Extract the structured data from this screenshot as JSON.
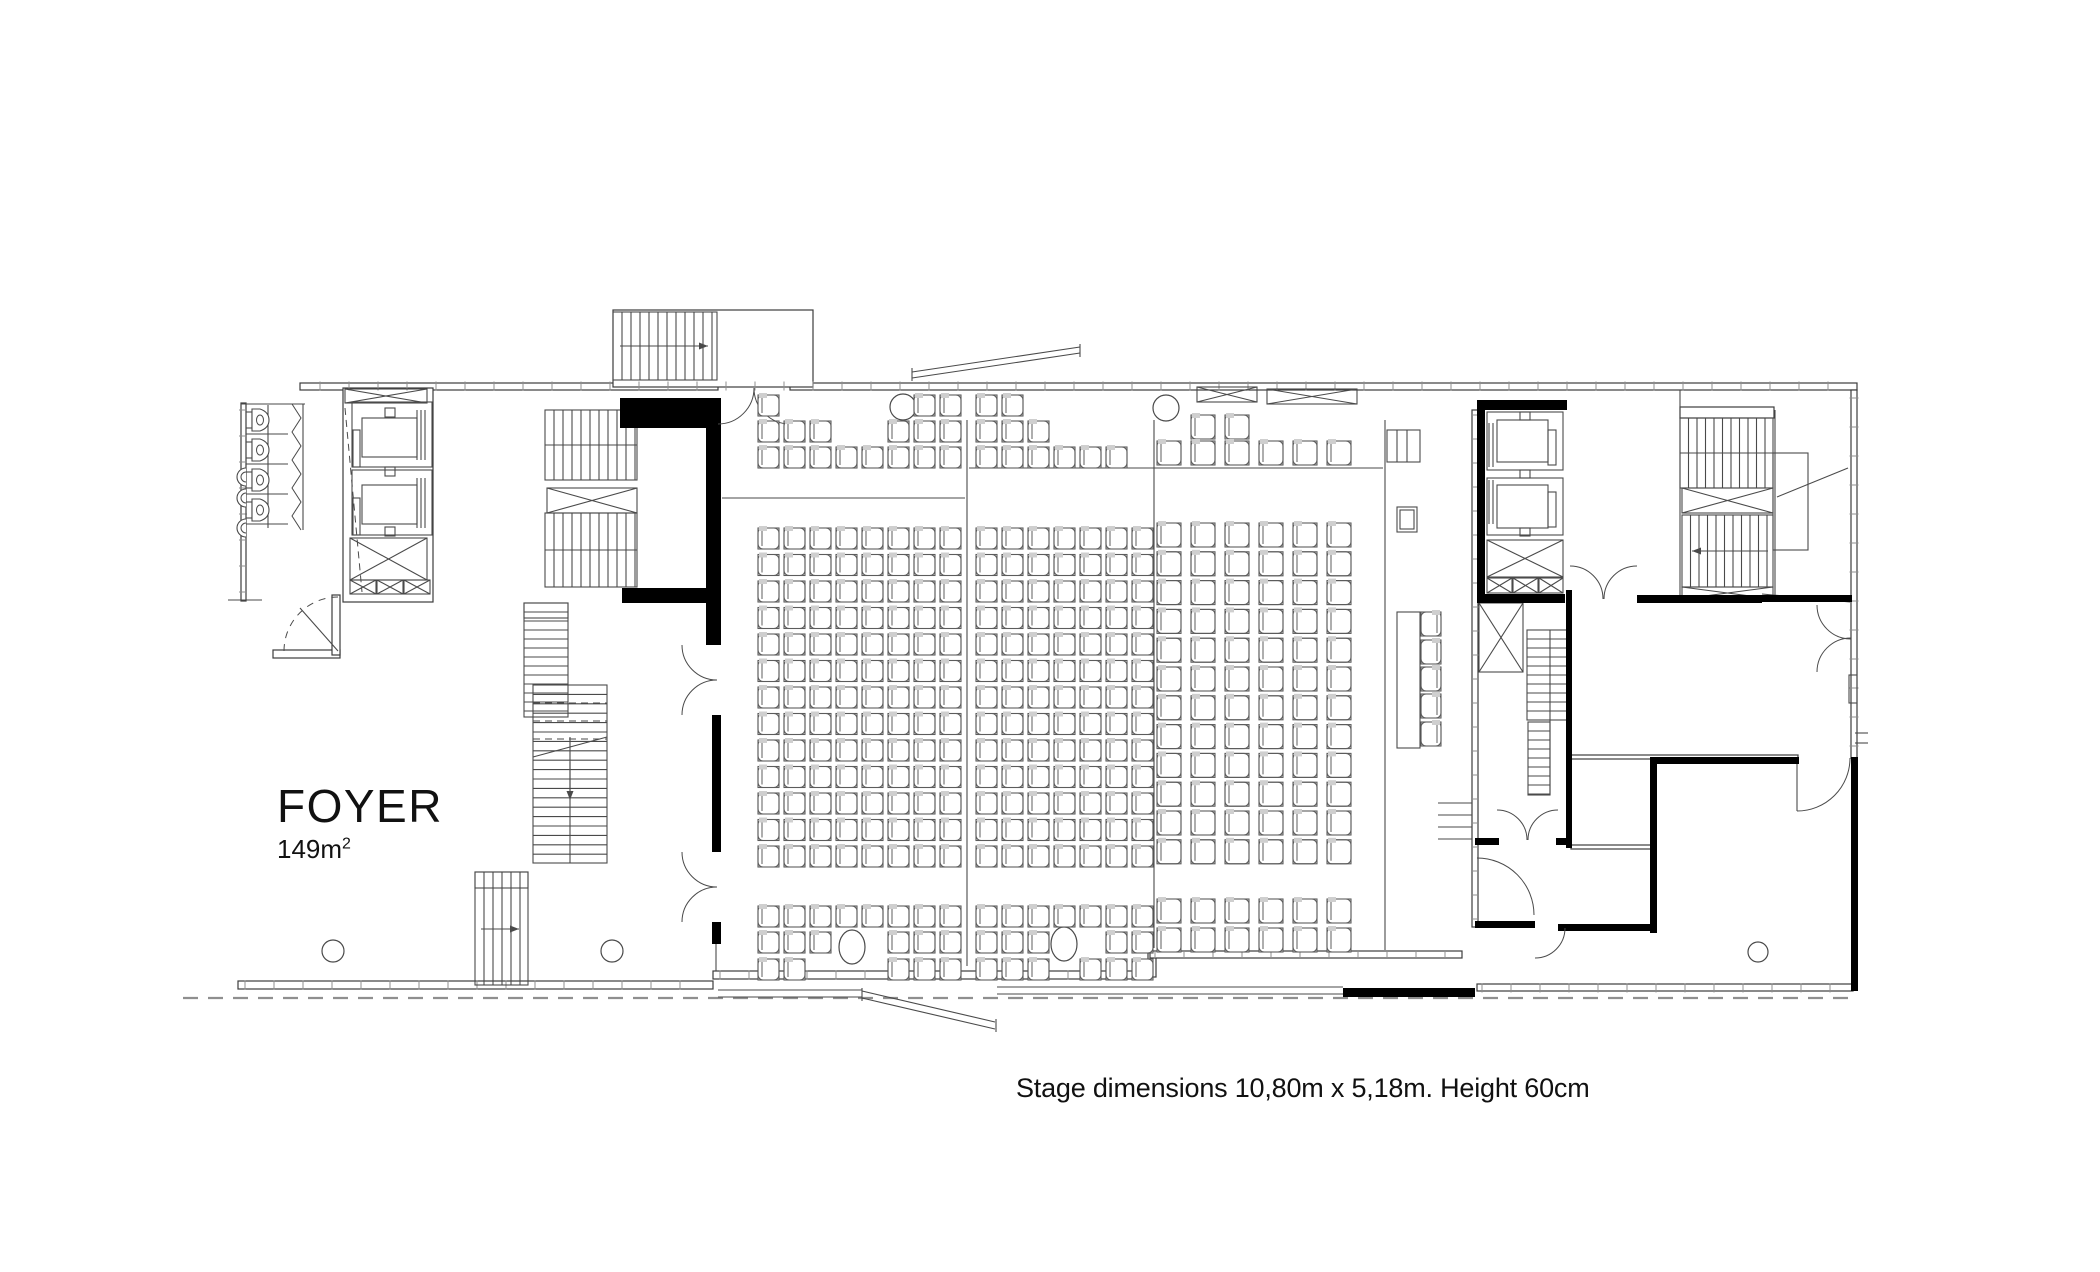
{
  "labels": {
    "room_name": "FOYER",
    "room_area_base": "149m",
    "room_area_exp": "2",
    "caption": "Stage dimensions 10,80m x 5,18m. Height 60cm"
  },
  "colors": {
    "background": "#ffffff",
    "line": "#4a4a4a",
    "line_light": "#8f8f8f",
    "wall_stroke": "#3c3c3c",
    "wall_black": "#000000",
    "seat": "#5c5c5c",
    "seat_tab": "#cfcfcf",
    "text": "#111111"
  },
  "canvas": {
    "width": 2100,
    "height": 1272
  },
  "plan": {
    "ground": [
      183,
      998,
      1852,
      998
    ],
    "walls": [
      [
        300,
        383,
        418,
        7
      ],
      [
        790,
        383,
        1067,
        7
      ],
      [
        613,
        310,
        200,
        77
      ],
      [
        241,
        403,
        5,
        198
      ],
      [
        238,
        981,
        475,
        8
      ],
      [
        713,
        971,
        437,
        8
      ],
      [
        1148,
        953,
        8,
        24
      ],
      [
        1150,
        951,
        312,
        7
      ],
      [
        1477,
        984,
        376,
        7
      ],
      [
        1851,
        390,
        6,
        368
      ],
      [
        343,
        388,
        90,
        214
      ],
      [
        1472,
        410,
        6,
        517
      ],
      [
        1570,
        755,
        228,
        4
      ],
      [
        1571,
        845,
        80,
        4
      ],
      [
        273,
        650,
        67,
        8
      ],
      [
        332,
        595,
        8,
        60
      ],
      [
        1680,
        407,
        94,
        11
      ]
    ],
    "blacks": [
      [
        620,
        398,
        92,
        30
      ],
      [
        706,
        398,
        15,
        247
      ],
      [
        712,
        715,
        9,
        137
      ],
      [
        712,
        922,
        9,
        22
      ],
      [
        622,
        588,
        88,
        15
      ],
      [
        1477,
        400,
        90,
        10
      ],
      [
        1477,
        400,
        8,
        203
      ],
      [
        1477,
        594,
        88,
        9
      ],
      [
        1637,
        595,
        125,
        8
      ],
      [
        1762,
        595,
        90,
        7
      ],
      [
        1566,
        590,
        6,
        258
      ],
      [
        1475,
        838,
        24,
        7
      ],
      [
        1556,
        838,
        16,
        7
      ],
      [
        1475,
        921,
        60,
        7
      ],
      [
        1558,
        924,
        99,
        7
      ],
      [
        1653,
        757,
        146,
        7
      ],
      [
        1650,
        757,
        7,
        176
      ],
      [
        1851,
        757,
        7,
        234
      ],
      [
        1343,
        988,
        132,
        9
      ]
    ],
    "xboxes": [
      [
        345,
        389,
        82,
        14
      ],
      [
        350,
        538,
        77,
        42
      ],
      [
        350,
        580,
        26,
        14
      ],
      [
        377,
        580,
        26,
        14
      ],
      [
        404,
        580,
        26,
        14
      ],
      [
        547,
        488,
        90,
        25
      ],
      [
        1487,
        540,
        76,
        37
      ],
      [
        1487,
        578,
        25,
        15
      ],
      [
        1513,
        578,
        25,
        15
      ],
      [
        1539,
        578,
        24,
        15
      ],
      [
        1479,
        603,
        44,
        69
      ],
      [
        1682,
        488,
        91,
        25
      ],
      [
        1682,
        587,
        91,
        12
      ],
      [
        1197,
        387,
        60,
        15
      ],
      [
        1267,
        389,
        90,
        15
      ]
    ],
    "stairs": [
      [
        613,
        312,
        104,
        68,
        "h",
        9
      ],
      [
        545,
        410,
        92,
        70,
        "h",
        9
      ],
      [
        545,
        513,
        92,
        74,
        "h",
        9
      ],
      [
        524,
        603,
        44,
        114,
        "v",
        9
      ],
      [
        533,
        685,
        74,
        178,
        "v",
        9.4
      ],
      [
        475,
        872,
        53,
        113,
        "h",
        9
      ],
      [
        1680,
        418,
        93,
        70,
        "h",
        8.5
      ],
      [
        1682,
        515,
        91,
        72,
        "h",
        8.5
      ],
      [
        1527,
        630,
        40,
        90,
        "v",
        9
      ],
      [
        1528,
        722,
        22,
        73,
        "v",
        9
      ]
    ],
    "rects": [
      [
        352,
        402,
        80,
        65
      ],
      [
        362,
        418,
        55,
        39
      ],
      [
        352,
        470,
        80,
        65
      ],
      [
        362,
        485,
        55,
        39
      ],
      [
        353,
        430,
        7,
        37
      ],
      [
        353,
        498,
        7,
        37
      ],
      [
        385,
        408,
        10,
        9
      ],
      [
        385,
        467,
        10,
        9
      ],
      [
        385,
        527,
        10,
        9
      ],
      [
        1487,
        412,
        76,
        58
      ],
      [
        1497,
        420,
        51,
        42
      ],
      [
        1487,
        478,
        76,
        57
      ],
      [
        1497,
        485,
        51,
        43
      ],
      [
        1548,
        430,
        8,
        35
      ],
      [
        1548,
        492,
        8,
        35
      ],
      [
        1520,
        412,
        10,
        8
      ],
      [
        1520,
        470,
        10,
        8
      ],
      [
        1520,
        528,
        10,
        8
      ],
      [
        1397,
        507,
        20,
        25
      ],
      [
        1400,
        510,
        14,
        19
      ],
      [
        1387,
        430,
        33,
        32
      ],
      [
        1397,
        612,
        23,
        136
      ],
      [
        1849,
        675,
        8,
        28
      ],
      [
        1773,
        453,
        35,
        97
      ],
      [
        524,
        603,
        44,
        15
      ],
      [
        475,
        872,
        53,
        16
      ]
    ],
    "lines": [
      [
        967,
        420,
        967,
        966
      ],
      [
        1154,
        420,
        1154,
        948
      ],
      [
        1385,
        420,
        1385,
        950
      ],
      [
        722,
        498,
        965,
        498
      ],
      [
        969,
        468,
        1383,
        468
      ],
      [
        268,
        405,
        268,
        528
      ],
      [
        241,
        404,
        305,
        404
      ],
      [
        246,
        434,
        288,
        434
      ],
      [
        246,
        464,
        288,
        464
      ],
      [
        246,
        494,
        288,
        494
      ],
      [
        246,
        524,
        288,
        524
      ],
      [
        303,
        404,
        303,
        530
      ],
      [
        228,
        600,
        262,
        600
      ],
      [
        417,
        410,
        417,
        460
      ],
      [
        421,
        410,
        421,
        460
      ],
      [
        425,
        410,
        425,
        460
      ],
      [
        417,
        478,
        417,
        528
      ],
      [
        421,
        478,
        421,
        528
      ],
      [
        425,
        478,
        425,
        528
      ],
      [
        1489,
        423,
        1489,
        467
      ],
      [
        1493,
        423,
        1493,
        467
      ],
      [
        1489,
        480,
        1489,
        524
      ],
      [
        1493,
        480,
        1493,
        524
      ],
      [
        1397,
        430,
        1397,
        462
      ],
      [
        1407,
        430,
        1407,
        462
      ],
      [
        1680,
        390,
        1680,
        601
      ],
      [
        1775,
        410,
        1775,
        601
      ],
      [
        1777,
        497,
        1848,
        468
      ],
      [
        1762,
        594,
        1850,
        602
      ],
      [
        1438,
        803,
        1472,
        803
      ],
      [
        1438,
        815,
        1472,
        815
      ],
      [
        1438,
        827,
        1472,
        827
      ],
      [
        1438,
        839,
        1472,
        839
      ],
      [
        912,
        378,
        1080,
        353
      ],
      [
        912,
        372,
        1080,
        347
      ],
      [
        912,
        368,
        912,
        381
      ],
      [
        1080,
        344,
        1080,
        357
      ],
      [
        718,
        990,
        862,
        990
      ],
      [
        718,
        997,
        862,
        997
      ],
      [
        862,
        991,
        995,
        1022
      ],
      [
        862,
        998,
        995,
        1029
      ],
      [
        997,
        987,
        1343,
        987
      ],
      [
        997,
        994,
        1343,
        994
      ],
      [
        862,
        988,
        862,
        1001
      ],
      [
        996,
        1019,
        996,
        1032
      ],
      [
        545,
        445,
        637,
        445
      ],
      [
        545,
        550,
        637,
        550
      ],
      [
        1680,
        453,
        1773,
        453
      ],
      [
        1550,
        630,
        1550,
        795
      ],
      [
        570,
        737,
        570,
        863
      ],
      [
        338,
        651,
        300,
        608
      ],
      [
        533,
        757,
        607,
        737
      ],
      [
        716,
        944,
        716,
        971
      ],
      [
        1797,
        758,
        1797,
        811
      ],
      [
        1855,
        733,
        1868,
        733
      ],
      [
        1855,
        743,
        1868,
        743
      ]
    ],
    "dashes": [
      [
        345,
        408,
        362,
        592
      ],
      [
        624,
        426,
        708,
        400
      ],
      [
        533,
        703,
        607,
        703
      ],
      [
        533,
        721,
        607,
        721
      ],
      [
        533,
        739,
        607,
        739
      ]
    ],
    "doors": [
      {
        "d": "M754,388 A36,36 0 0 1 718,424"
      },
      {
        "d": "M754,388 A36,36 0 0 0 790,424"
      },
      {
        "d": "M682,645 A35,35 0 0 0 717,680"
      },
      {
        "d": "M682,715 A35,35 0 0 1 717,680"
      },
      {
        "d": "M682,852 A35,35 0 0 0 717,887"
      },
      {
        "d": "M682,922 A35,35 0 0 1 717,887"
      },
      {
        "d": "M1603,599 A33,33 0 0 0 1570,566"
      },
      {
        "d": "M1604,599 A33,33 0 0 1 1637,566"
      },
      {
        "d": "M1817,605 A34,34 0 0 0 1851,639"
      },
      {
        "d": "M1817,672 A34,34 0 0 1 1851,638"
      },
      {
        "d": "M1850,758 A53,53 0 0 1 1797,811"
      },
      {
        "d": "M1527,840 A30,30 0 0 0 1497,810"
      },
      {
        "d": "M1528,840 A30,30 0 0 1 1558,810"
      },
      {
        "d": "M1477,858 A57,57 0 0 1 1534,915"
      },
      {
        "d": "M1565,928 A30,30 0 0 1 1535,958"
      },
      {
        "d": "M284,651 A54,54 0 0 1 338,597",
        "dash": true
      }
    ],
    "circles": [
      [
        903,
        407,
        13
      ],
      [
        1166,
        408,
        13
      ],
      [
        333,
        951,
        11
      ],
      [
        612,
        951,
        11
      ],
      [
        1758,
        952,
        10
      ]
    ],
    "ellipses": [
      [
        852,
        947,
        13,
        17
      ],
      [
        1064,
        944,
        13,
        17
      ]
    ],
    "tickruns": [
      [
        320,
        386,
        1845,
        386,
        29,
        9
      ],
      [
        720,
        975,
        1145,
        975,
        29,
        9
      ],
      [
        245,
        985,
        708,
        985,
        29,
        9
      ],
      [
        1482,
        988,
        1848,
        988,
        29,
        9
      ],
      [
        1854,
        398,
        1854,
        752,
        29,
        9
      ],
      [
        243,
        410,
        243,
        595,
        26,
        8
      ],
      [
        1475,
        415,
        1475,
        922,
        24,
        8
      ],
      [
        1155,
        954,
        1458,
        954,
        29,
        8
      ]
    ],
    "toilets": {
      "x": 246,
      "cys": [
        420,
        450,
        480,
        510
      ]
    },
    "urinals": {
      "x": 246,
      "cys": [
        477,
        498,
        528
      ]
    },
    "zigzags": [
      {
        "x": 292,
        "y0": 404,
        "y1": 530,
        "amp": 9,
        "n": 9
      }
    ],
    "arrows": [
      [
        620,
        346,
        708,
        346
      ],
      [
        1768,
        551,
        1692,
        551
      ],
      [
        481,
        929,
        519,
        929
      ],
      [
        570,
        762,
        570,
        800
      ]
    ],
    "seat_blocks": [
      {
        "cols": [
          758,
          784,
          810,
          836,
          862,
          888,
          914,
          940
        ],
        "size": 21,
        "sections": [
          {
            "rows": [
              395,
              421,
              447
            ],
            "occ": [
              [
                1,
                1,
                1
              ],
              [
                0,
                1,
                1
              ],
              [
                0,
                1,
                1
              ],
              [
                0,
                0,
                1
              ],
              [
                0,
                0,
                1
              ],
              [
                0,
                1,
                1
              ],
              [
                1,
                1,
                1
              ],
              [
                1,
                1,
                1
              ]
            ]
          },
          {
            "rowStart": 528,
            "rowPitch": 26.5,
            "rowCount": 13,
            "occ": "all"
          },
          {
            "rows": [
              906,
              932,
              959
            ],
            "occ": [
              [
                1,
                1,
                1
              ],
              [
                1,
                1,
                1
              ],
              [
                1,
                1,
                0
              ],
              [
                1,
                0,
                0
              ],
              [
                1,
                0,
                0
              ],
              [
                1,
                1,
                1
              ],
              [
                1,
                1,
                1
              ],
              [
                1,
                1,
                1
              ]
            ]
          }
        ]
      },
      {
        "cols": [
          976,
          1002,
          1028,
          1054,
          1080,
          1106,
          1132
        ],
        "size": 21,
        "sections": [
          {
            "rows": [
              395,
              421,
              447
            ],
            "occ": [
              [
                1,
                1,
                1
              ],
              [
                1,
                1,
                1
              ],
              [
                0,
                1,
                1
              ],
              [
                0,
                0,
                1
              ],
              [
                0,
                0,
                1
              ],
              [
                0,
                0,
                1
              ],
              [
                0,
                0,
                0
              ]
            ]
          },
          {
            "rowStart": 528,
            "rowPitch": 26.5,
            "rowCount": 13,
            "occ": "all"
          },
          {
            "rows": [
              906,
              932,
              959
            ],
            "occ": [
              [
                1,
                1,
                1
              ],
              [
                1,
                1,
                1
              ],
              [
                1,
                1,
                1
              ],
              [
                1,
                0,
                0
              ],
              [
                1,
                0,
                1
              ],
              [
                1,
                1,
                1
              ],
              [
                1,
                1,
                1
              ]
            ]
          }
        ]
      },
      {
        "cols": [
          1157,
          1191,
          1225,
          1259,
          1293,
          1327
        ],
        "size": 24,
        "sections": [
          {
            "rows": [
              415,
              441
            ],
            "occ": [
              [
                0,
                1
              ],
              [
                1,
                1
              ],
              [
                1,
                1
              ],
              [
                0,
                1
              ],
              [
                0,
                1
              ],
              [
                0,
                1
              ]
            ]
          },
          {
            "rowStart": 523,
            "rowPitch": 28.8,
            "rowCount": 12,
            "occ": "all"
          },
          {
            "rows": [
              899,
              928
            ],
            "occ": "all"
          }
        ]
      }
    ],
    "head_chairs": {
      "x": 1421,
      "ys": [
        612,
        640,
        667,
        694,
        722
      ],
      "w": 20,
      "h": 24
    }
  }
}
